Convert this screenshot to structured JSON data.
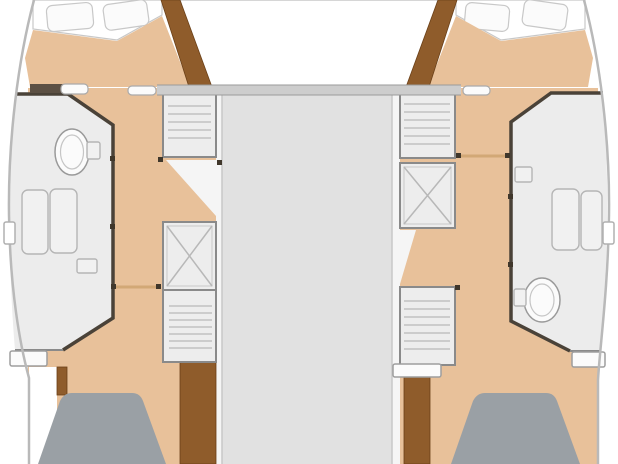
{
  "image": {
    "kind": "boat-floor-plan",
    "subject": "catamaran lower-deck layout, port and starboard hulls with cabins, heads, companionway stairs and berths",
    "width_px": 618,
    "height_px": 464,
    "visible_text": ""
  },
  "colors": {
    "background": "#ffffff",
    "floor": "#e8c19a",
    "wood": "#8f5c2b",
    "deck": "#e1e1e1",
    "room": "#ececec",
    "unit": "#ededed",
    "berth": "#9aa0a5",
    "bulkhead": "#cdcdcd",
    "dark_wall": "#4a4238",
    "white_fixture": "#fbfbfb",
    "liner": "#f5f5f5",
    "door": "#d2a876",
    "hull_outline": "#b9b9b9",
    "hinge_dot": "#40372b",
    "dark_stub": "#5c5044",
    "white": "#ffffff"
  },
  "features": [
    {
      "name": "port-fore-berth",
      "kind": "bed with two pillows, top left"
    },
    {
      "name": "starboard-fore-berth",
      "kind": "bed with two pillows, top right"
    },
    {
      "name": "port-head",
      "kind": "bathroom with toilet, sink and shower, port hull"
    },
    {
      "name": "starboard-head",
      "kind": "bathroom with shower and toilet, starboard hull"
    },
    {
      "name": "port-stairs-fwd",
      "kind": "companionway steps"
    },
    {
      "name": "port-hatch",
      "kind": "crossed access hatch"
    },
    {
      "name": "port-stairs-aft",
      "kind": "companionway steps"
    },
    {
      "name": "starboard-stairs-fwd",
      "kind": "companionway steps"
    },
    {
      "name": "starboard-hatch",
      "kind": "crossed access hatch"
    },
    {
      "name": "starboard-stairs-aft",
      "kind": "companionway steps"
    },
    {
      "name": "port-aft-berth",
      "kind": "gray double berth, bottom left"
    },
    {
      "name": "starboard-aft-berth",
      "kind": "gray double berth, bottom right"
    },
    {
      "name": "center-walkway",
      "kind": "bridgedeck between hulls"
    },
    {
      "name": "cabin-doors",
      "kind": "open door leaves with hinge dots"
    }
  ]
}
